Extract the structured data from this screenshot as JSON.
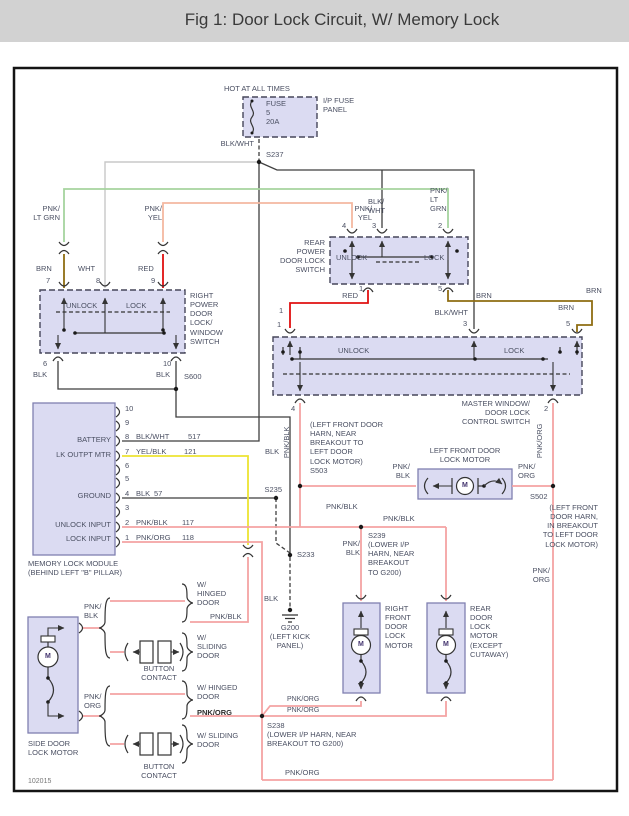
{
  "title": "Fig 1: Door Lock Circuit, W/ Memory Lock",
  "footer_code": "102015",
  "colors": {
    "banner": "#d2d2d2",
    "box_fill": "#dbdbf2",
    "wire_black": "#3f3f3f",
    "wire_white": "#c8c8c8",
    "wire_red": "#e01010",
    "wire_brown": "#8f6d12",
    "wire_green": "#a6d49e",
    "wire_pink_yellow": "#f4b8a0",
    "wire_yellow": "#ede432",
    "wire_pink": "#f4a3a3"
  },
  "fuse": {
    "hot": "HOT AT ALL TIMES",
    "text": "FUSE\n5\n20A",
    "panel": "I/P FUSE\nPANEL",
    "wire": "BLK/WHT",
    "splice": "S237"
  },
  "right_switch": {
    "conn_green": "PNK/\nLT GRN",
    "conn_yel": "PNK/\nYEL",
    "w7": "BRN",
    "w8": "WHT",
    "w9": "RED",
    "p7": "7",
    "p8": "8",
    "p9": "9",
    "unlock": "UNLOCK",
    "lock": "LOCK",
    "name": "RIGHT\nPOWER\nDOOR\nLOCK/\nWINDOW\nSWITCH",
    "p6": "6",
    "w6": "BLK",
    "p10": "10",
    "w10": "BLK",
    "splice": "S600"
  },
  "rear_switch": {
    "w4": "PNK/\nYEL",
    "w3": "BLK/\nWHT",
    "w2": "PNK/\nLT\nGRN",
    "p4": "4",
    "p3": "3",
    "p2": "2",
    "name": "REAR\nPOWER\nDOOR LOCK\nSWITCH",
    "unlock": "UNLOCK",
    "lock": "LOCK",
    "p1": "1",
    "w1": "RED",
    "p5": "5",
    "w5": "BRN"
  },
  "master_switch": {
    "brn_corner": "BRN",
    "w5": "BRN",
    "p5": "5",
    "w3": "BLK/WHT",
    "p3": "3",
    "c1a": "1",
    "c1b": "1",
    "unlock": "UNLOCK",
    "lock": "LOCK",
    "name": "MASTER WINDOW/\nDOOR LOCK\nCONTROL SWITCH",
    "p4": "4",
    "w4": "PNK/BLK",
    "p2": "2",
    "w2": "PNK/ORG"
  },
  "memory": {
    "pins": [
      "10",
      "9",
      "8",
      "7",
      "6",
      "5",
      "4",
      "3",
      "2",
      "1"
    ],
    "battery": "BATTERY",
    "lk_outpt": "LK OUTPT MTR",
    "ground": "GROUND",
    "unlock_in": "UNLOCK INPUT",
    "lock_in": "LOCK INPUT",
    "w8": "BLK/WHT",
    "g8": "517",
    "w7": "YEL/BLK",
    "g7": "121",
    "w4": "BLK",
    "g4": "57",
    "w2": "PNK/BLK",
    "g2": "117",
    "w1": "PNK/ORG",
    "g1": "118",
    "name": "MEMORY LOCK MODULE\n(BEHIND LEFT \"B\" PILLAR)"
  },
  "lf_motor": {
    "name": "LEFT FRONT DOOR\nLOCK MOTOR",
    "wl": "PNK/\nBLK",
    "wr": "PNK/\nORG",
    "s503": "(LEFT FRONT DOOR\nHARN, NEAR\nBREAKOUT TO\nLEFT DOOR\nLOCK MOTOR)\nS503",
    "s502": "S502",
    "s502_note": "(LEFT FRONT\nDOOR HARN,\nIN BREAKOUT\nTO LEFT DOOR\nLOCK MOTOR)",
    "wr2": "PNK/\nORG"
  },
  "splices": {
    "blk_mid": "BLK",
    "s235": "S235",
    "s233": "S233",
    "blk_low": "BLK",
    "g200": "G200\n(LEFT KICK\nPANEL)",
    "pnkblk_a": "PNK/BLK",
    "pnkblk_b": "PNK/BLK",
    "pnkblk_c": "PNK/\nBLK",
    "s239": "S239\n(LOWER I/P\nHARN, NEAR\nBREAKOUT\nTO G200)",
    "s238": "S238\n(LOWER I/P HARN, NEAR\nBREAKOUT TO G200)"
  },
  "side_door": {
    "wt": "PNK/\nBLK",
    "hinged1": "W/\nHINGED\nDOOR",
    "pnkblk": "PNK/BLK",
    "sliding1": "W/\nSLIDING\nDOOR",
    "btn1": "BUTTON\nCONTACT",
    "wb": "PNK/\nORG",
    "hinged2": "W/ HINGED\nDOOR",
    "pnkorg": "PNK/ORG",
    "sliding2": "W/ SLIDING\nDOOR",
    "btn2": "BUTTON\nCONTACT",
    "name": "SIDE DOOR\nLOCK MOTOR"
  },
  "motors": {
    "m": "M",
    "rf_name": "RIGHT\nFRONT\nDOOR\nLOCK\nMOTOR",
    "rear_name": "REAR\nDOOR\nLOCK\nMOTOR\n(EXCEPT\nCUTAWAY)",
    "porg1": "PNK/ORG",
    "porg2": "PNK/ORG",
    "porg3": "PNK/ORG"
  }
}
